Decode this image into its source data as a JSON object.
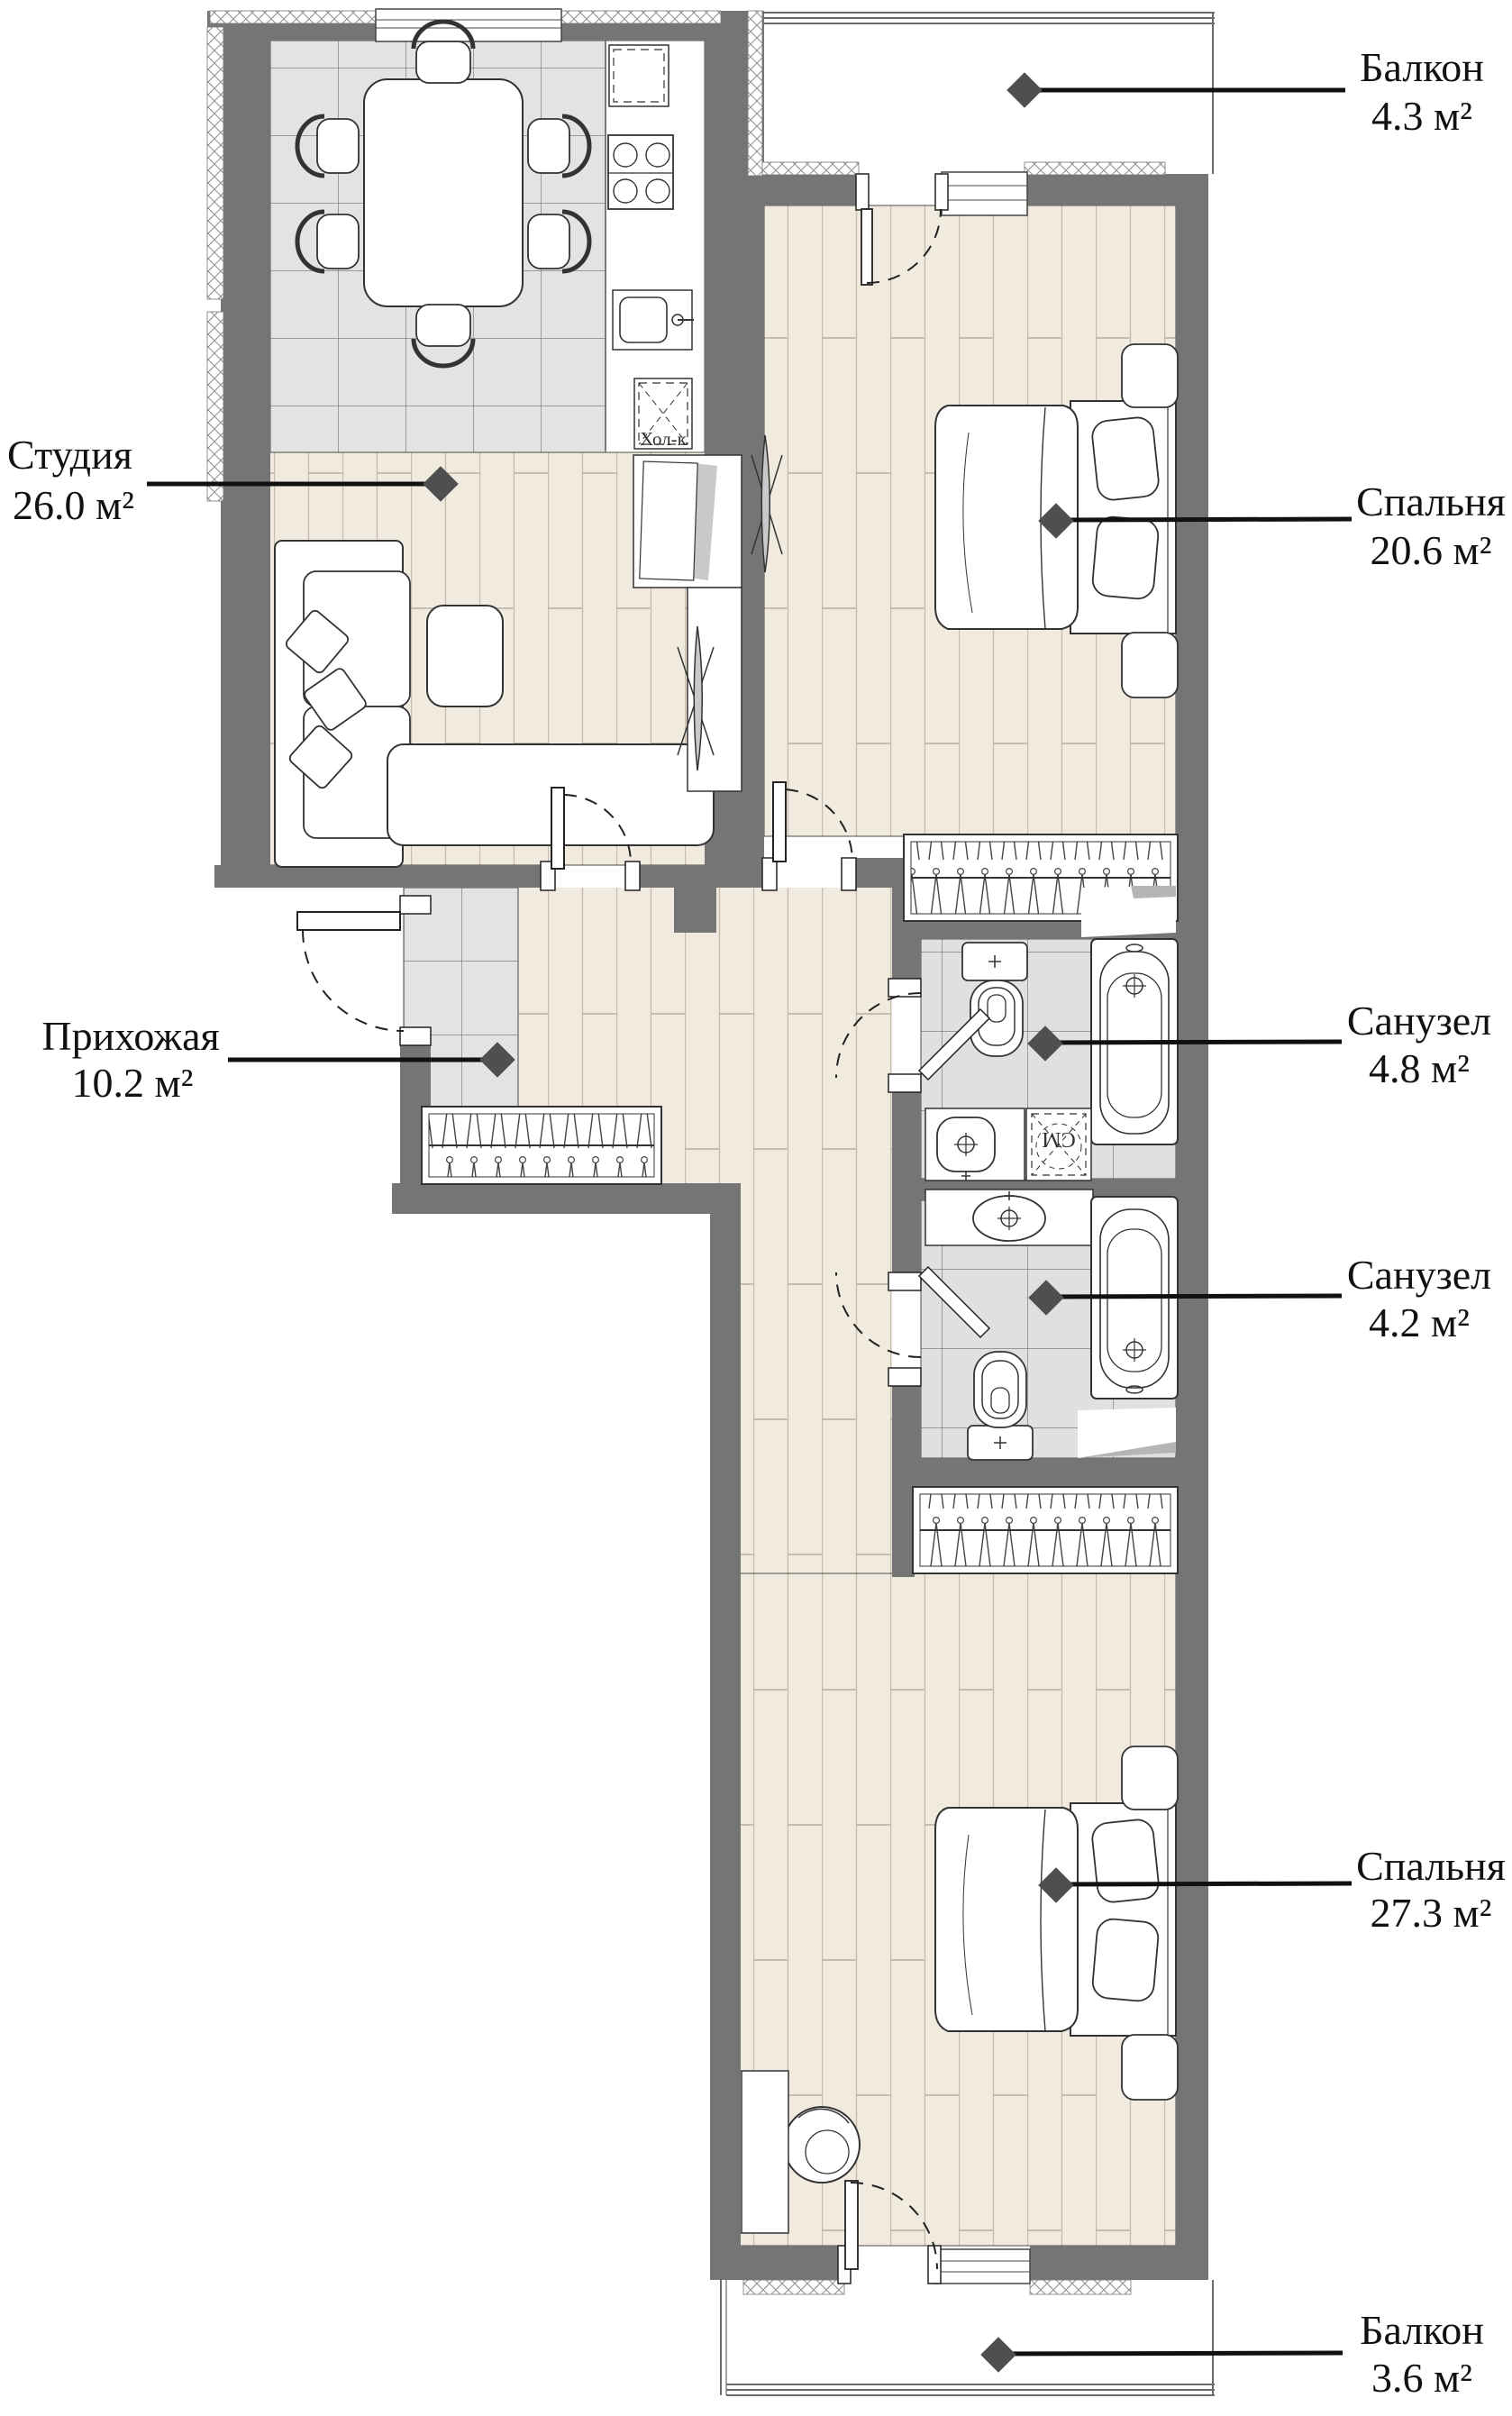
{
  "rooms": [
    {
      "id": "balcony-top",
      "name": "Балкон",
      "area": "4.3 м²"
    },
    {
      "id": "bedroom-top",
      "name": "Спальня",
      "area": "20.6 м²"
    },
    {
      "id": "studio",
      "name": "Студия",
      "area": "26.0 м²"
    },
    {
      "id": "hallway",
      "name": "Прихожая",
      "area": "10.2 м²"
    },
    {
      "id": "bathroom-1",
      "name": "Санузел",
      "area": "4.8 м²"
    },
    {
      "id": "bathroom-2",
      "name": "Санузел",
      "area": "4.2 м²"
    },
    {
      "id": "bedroom-bottom",
      "name": "Спальня",
      "area": "27.3 м²"
    },
    {
      "id": "balcony-bottom",
      "name": "Балкон",
      "area": "3.6 м²"
    }
  ],
  "annotations": {
    "fridge_label": "Хол-к",
    "washer_label": "СМ"
  },
  "colors": {
    "wall": "#757575",
    "wood_floor": "#f1eade",
    "kitchen_tile": "#e3e3e3",
    "bath_tile": "#e0e0e0",
    "marker": "#4f4f4f",
    "leader_line": "#111111"
  }
}
